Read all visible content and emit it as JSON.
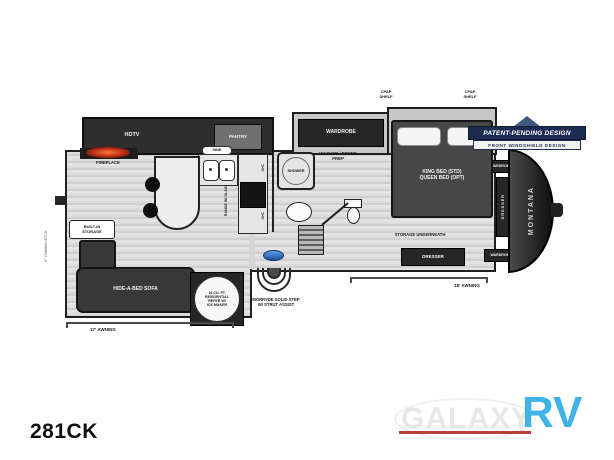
{
  "model": "281CK",
  "badge": {
    "title": "PATENT-PENDING DESIGN",
    "subtitle": "FRONT WINDSHIELD DESIGN"
  },
  "plan": {
    "hdtv": "HDTV",
    "pantry": "PANTRY",
    "fireplace": "FIREPLACE",
    "wardrobe_slide": "WARDROBE",
    "cpap_left": {
      "l1": "CPAP",
      "l2": "SHELF"
    },
    "cpap_right": {
      "l1": "CPAP",
      "l2": "SHELF"
    },
    "bed": {
      "l1": "KING BED (STD)",
      "l2": "QUEEN BED (OPT)"
    },
    "shower": "SHOWER",
    "washer_dryer": {
      "l1": "WASHER / DRYER",
      "l2": "PREP"
    },
    "sink": "SINK",
    "range": "RANGE W/ GLASS TOP",
    "ohc_upper": "OHC",
    "ohc_lower": "OHC",
    "refer": {
      "l1": "18 CU. FT.",
      "l2": "RESIDENTIAL",
      "l3": "REFER W/",
      "l4": "ICE MAKER"
    },
    "builtin": {
      "l1": "BUILT-IN",
      "l2": "STORAGE"
    },
    "sofa": "HIDE-A-BED SOFA",
    "step": {
      "l1": "MORRYDE SOLID STEP",
      "l2": "W/ STRUT ASSIST"
    },
    "storage_underneath": "STORAGE UNDERNEATH",
    "dresser": "DRESSER",
    "front": {
      "wardrobe_top": "WARDROBE",
      "dresser": "DRESSER",
      "wardrobe_bottom": "WARDROBE",
      "brand": "MONTANA"
    },
    "awning_left": "17' AWNING",
    "awning_right": "18' AWNING",
    "rear_hitch": "2\" TOWING HITCH"
  },
  "logo": {
    "galaxy": "GALAXY",
    "rv": "RV"
  },
  "colors": {
    "accent_blue": "#3fb2e8",
    "underline_red": "#b5403a",
    "badge_navy": "#1b2b52"
  }
}
